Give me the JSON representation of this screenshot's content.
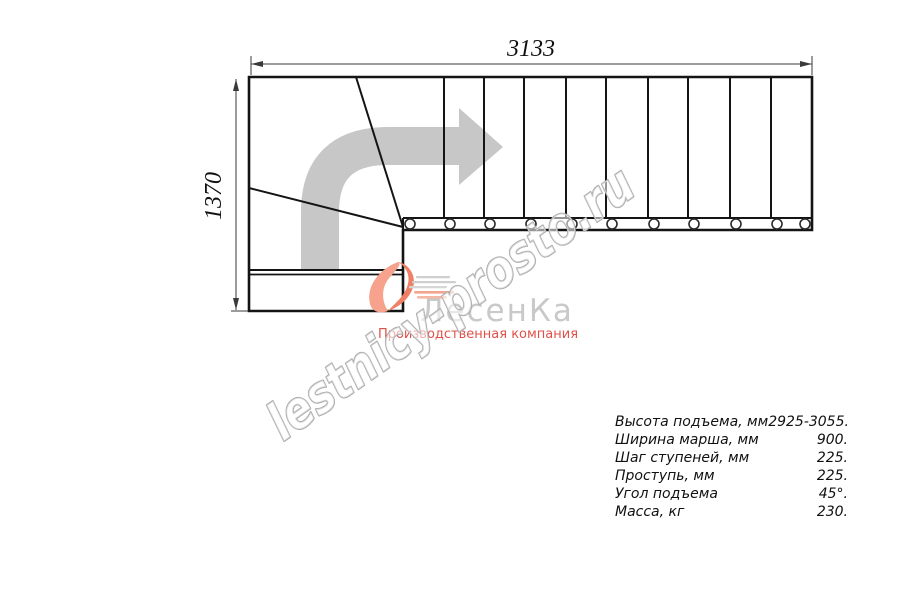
{
  "drawing": {
    "dim_width_mm": "3133",
    "dim_height_mm": "1370"
  },
  "plan": {
    "straight_tread_count": 10,
    "winder_tread_count": 3,
    "tread_line_xs": [
      444,
      484,
      524,
      566,
      606,
      648,
      688,
      730,
      771
    ],
    "baluster_xs": [
      410,
      450,
      490,
      531,
      572,
      612,
      654,
      694,
      736,
      777,
      805
    ]
  },
  "logo": {
    "brand": "ЛесенКа",
    "tagline": "Производственная компания",
    "accent_color": "#ef8066",
    "brand_color": "#c9c9c9",
    "tagline_color": "#e0514a"
  },
  "watermark": {
    "text": "lestnicy-prosto.ru",
    "outline_color": "#a9a9a9"
  },
  "direction_arrow": {
    "meaning": "ascent direction: up then right",
    "color": "#c7c7c7"
  },
  "specs": {
    "rows": [
      {
        "label": "Высота подъема, мм",
        "value": "2925-3055."
      },
      {
        "label": "Ширина марша, мм",
        "value": "900."
      },
      {
        "label": "Шаг ступеней, мм",
        "value": "225."
      },
      {
        "label": "Проступь, мм",
        "value": "225."
      },
      {
        "label": "Угол подъема",
        "value": "45°."
      },
      {
        "label": "Масса, кг",
        "value": "230."
      }
    ]
  }
}
